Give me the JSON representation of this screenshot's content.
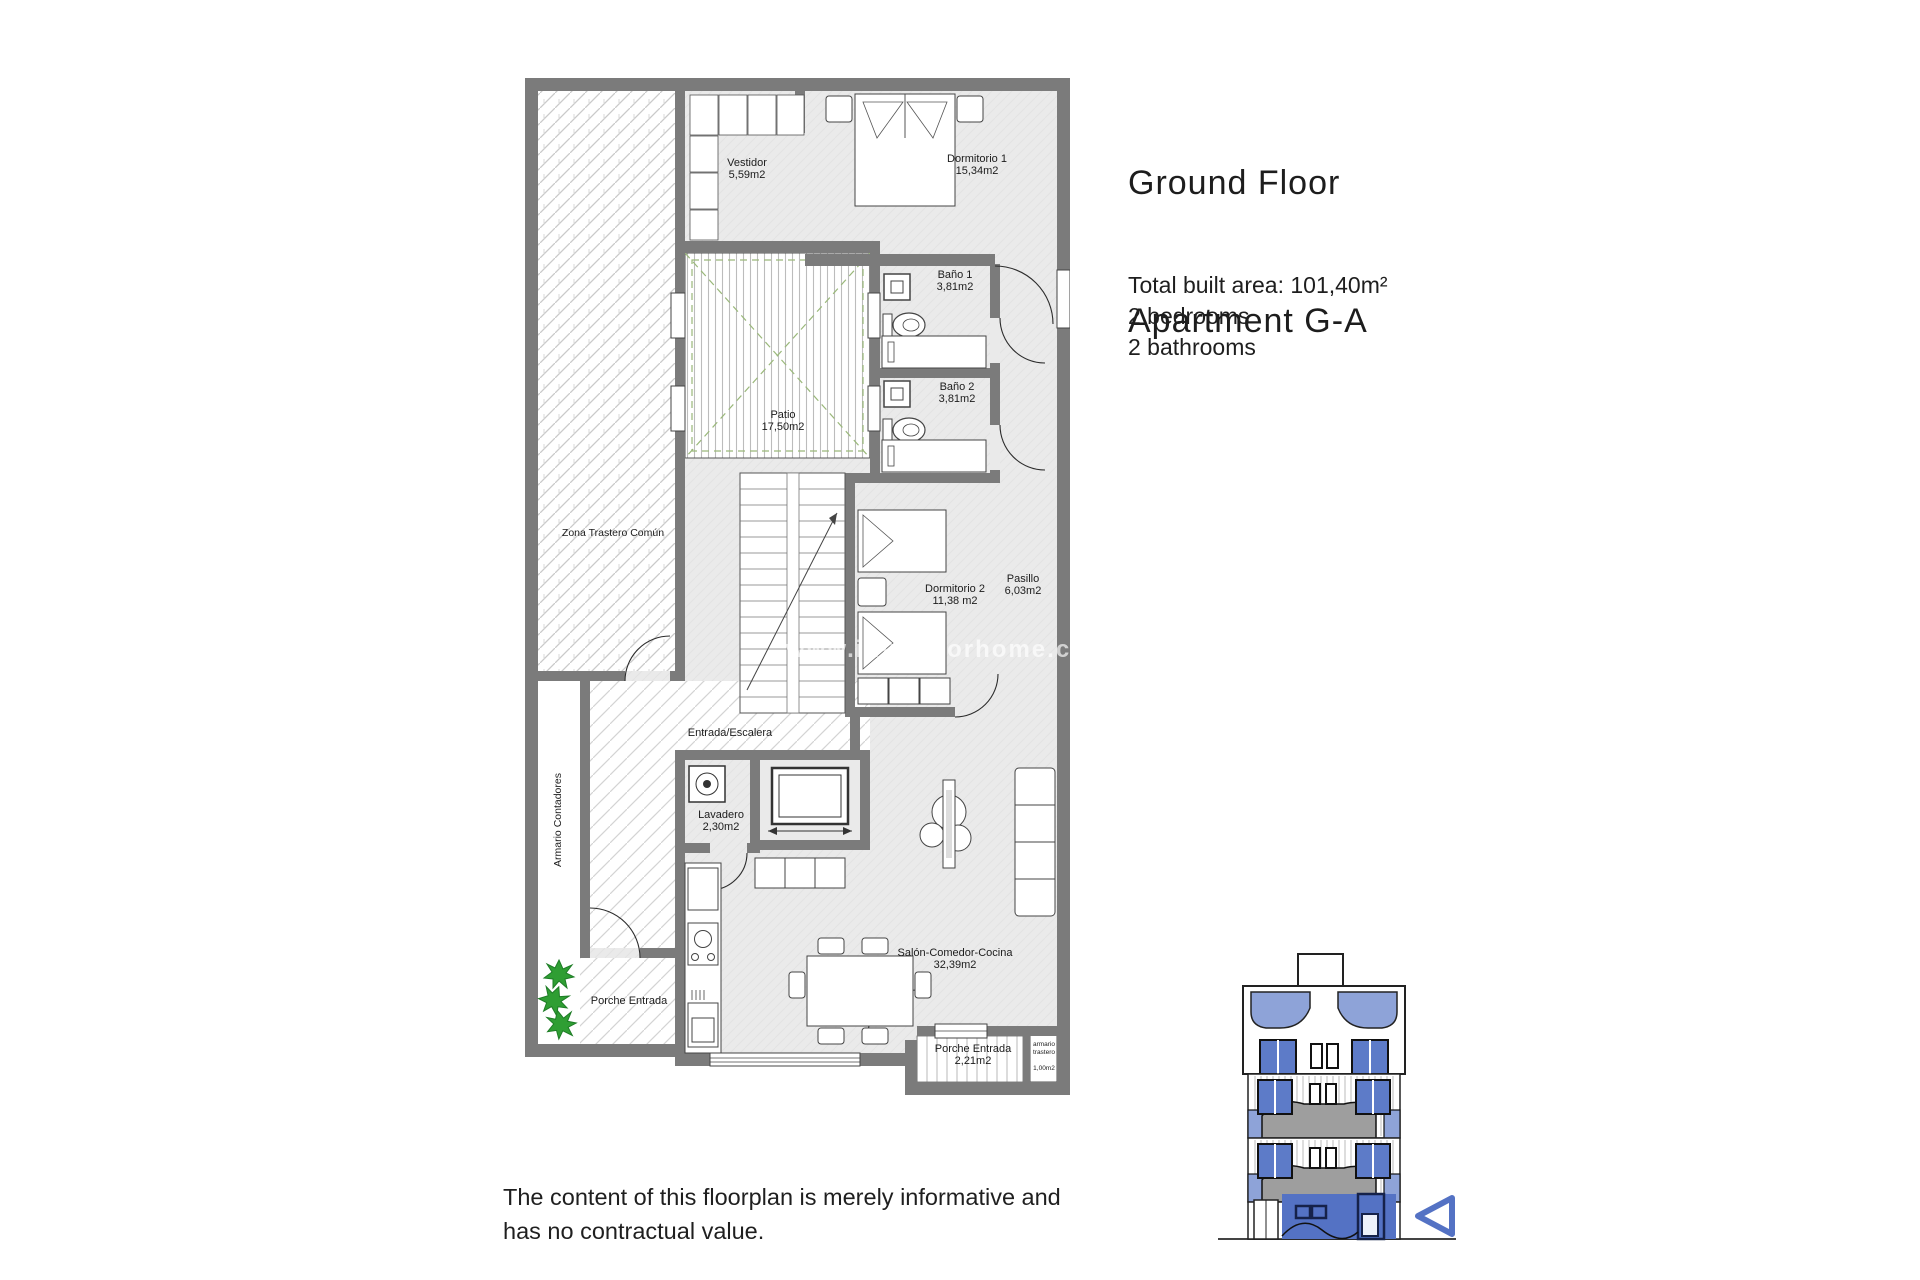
{
  "header": {
    "title_line1": "Ground Floor",
    "title_line2": "Apartment G-A"
  },
  "summary": {
    "total_area": "Total built area: 101,40m²",
    "bedrooms": "2 bedrooms",
    "bathrooms": "2 bathrooms"
  },
  "disclaimer": {
    "line1": "The content of this floorplan is merely informative and",
    "line2": "has no contractual value."
  },
  "watermark": "www.investforhome.c",
  "rooms": {
    "vestidor": {
      "name": "Vestidor",
      "area": "5,59m2"
    },
    "dormitorio1": {
      "name": "Dormitorio 1",
      "area": "15,34m2"
    },
    "bano1": {
      "name": "Baño 1",
      "area": "3,81m2"
    },
    "bano2": {
      "name": "Baño 2",
      "area": "3,81m2"
    },
    "patio": {
      "name": "Patio",
      "area": "17,50m2"
    },
    "zona_trastero": {
      "name": "Zona Trastero Común"
    },
    "dormitorio2": {
      "name": "Dormitorio 2",
      "area": "11,38 m2"
    },
    "pasillo": {
      "name": "Pasillo",
      "area": "6,03m2"
    },
    "entrada": {
      "name": "Entrada/Escalera"
    },
    "lavadero": {
      "name": "Lavadero",
      "area": "2,30m2"
    },
    "armario_contadores": {
      "name": "Armario Contadores"
    },
    "salon": {
      "name": "Salón-Comedor-Cocina",
      "area": "32,39m2"
    },
    "porche_izquierda": {
      "name": "Porche Entrada"
    },
    "porche_derecha": {
      "name": "Porche Entrada",
      "area": "2,21m2"
    },
    "armario_trastero": {
      "name_line1": "armario",
      "name_line2": "trastero",
      "area": "1,00m2"
    }
  },
  "colors": {
    "wall": "#7b7b7b",
    "floor": "#eaeaea",
    "patio_green": "#9ab87a",
    "plant_green": "#2f9e33",
    "highlight_blue": "#5472c4",
    "light_blue": "#8ea3d8"
  }
}
